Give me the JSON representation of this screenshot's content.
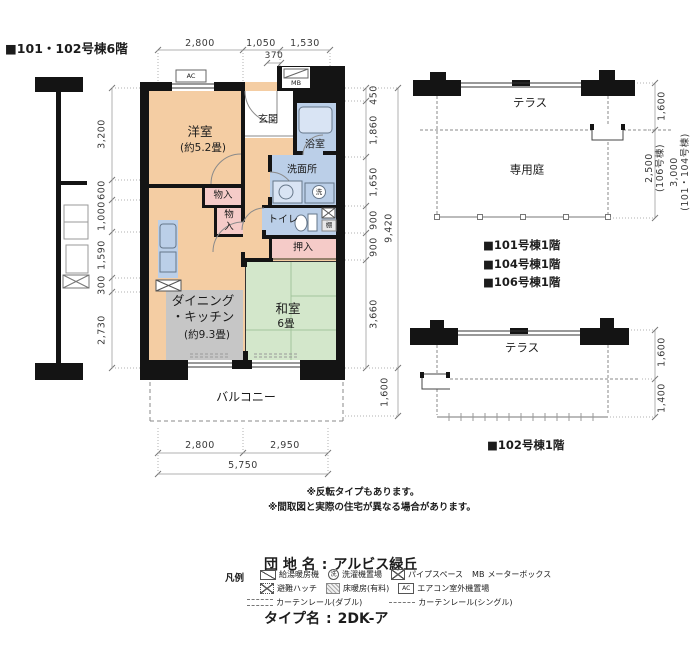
{
  "page": {
    "title_label": "■101・102号棟6階"
  },
  "colors": {
    "room": "#f4cda3",
    "tatami": "#d3e7cb",
    "wet": "#bbcfe8",
    "closet": "#f5cbc8",
    "heating": "#c6c6c6",
    "wall": "#141414"
  },
  "plan": {
    "rooms": {
      "western": {
        "name": "洋室",
        "size": "(約5.2畳)"
      },
      "dk": {
        "name": "ダイニング\n・キッチン",
        "size": "(約9.3畳)"
      },
      "japanese": {
        "name": "和室",
        "size": "6畳"
      },
      "entrance": "玄関",
      "bath": "浴室",
      "washroom": "洗面所",
      "toilet": "トイレ",
      "oshiire": "押入",
      "monoire_a": "物入",
      "monoire_b": "物\n入",
      "balcony": "バルコニー",
      "shelf": "棚",
      "washer_mark": "洗",
      "ac": "AC",
      "mb": "MB"
    },
    "dims": {
      "top": [
        "2,800",
        "1,050",
        "1,530"
      ],
      "top_sub": "370",
      "left": [
        "3,200",
        "600",
        "1,000",
        "1,590",
        "300",
        "2,730"
      ],
      "right": [
        "450",
        "1,860",
        "1,650",
        "900",
        "900",
        "3,660"
      ],
      "right_total": "9,420",
      "balcony_depth": "1,600",
      "bottom": [
        "2,800",
        "2,950"
      ],
      "bottom_total": "5,750"
    }
  },
  "site_upper": {
    "terrace": "テラス",
    "garden": "専用庭",
    "dim_terrace": "1,600",
    "dim_garden_106": "2,500\n(106号棟)",
    "dim_garden_101": "3,000\n(101・104号棟)",
    "captions": [
      "■101号棟1階",
      "■104号棟1階",
      "■106号棟1階"
    ]
  },
  "site_lower": {
    "terrace": "テラス",
    "dim_terrace": "1,600",
    "dim_front": "1,400",
    "caption": "■102号棟1階"
  },
  "notes": [
    "※反転タイプもあります。",
    "※間取図と実際の住宅が異なる場合があります。"
  ],
  "estate": {
    "name_label": "団 地 名",
    "name_value": "アルビス緑丘",
    "type_label": "タイプ名",
    "type_value": "2DK-ア",
    "colon": ":"
  },
  "legend": {
    "title": "凡例",
    "water_heater": "給湯暖房機",
    "laundry": "洗濯機置場",
    "laundry_mark": "洗",
    "pipe_space": "パイプスペース",
    "mb_abbr": "MB",
    "meter_box": "メーターボックス",
    "hatch": "避難ハッチ",
    "floor_heating": "床暖房(有料)",
    "ac_abbr": "AC",
    "ac_outdoor": "エアコン室外機置場",
    "curtain_double": "カーテンレール(ダブル)",
    "curtain_single": "カーテンレール(シングル)"
  }
}
